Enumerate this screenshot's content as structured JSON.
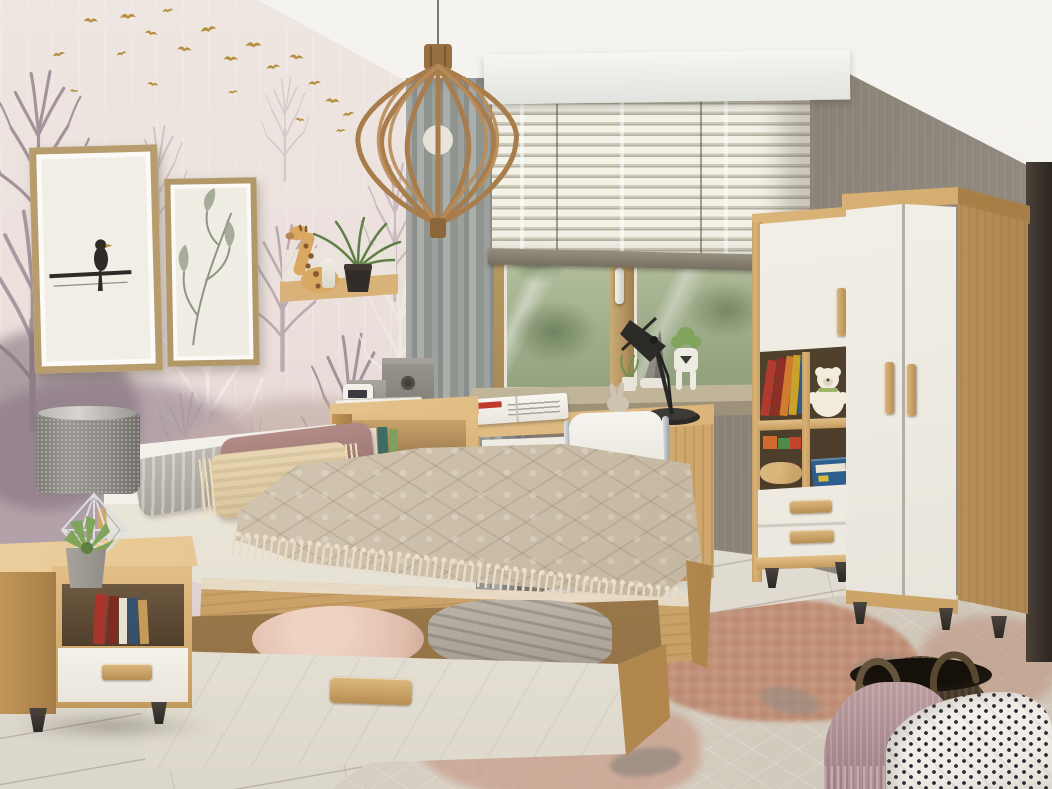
{
  "meta": {
    "type": "interior-photograph",
    "room": "youth bedroom",
    "style": "scandinavian light-oak and white-gloss furniture set",
    "description": "Bright bedroom: forest-mural wallpaper with gold birds on the left wall, two framed prints, wooden cage pendant lamp, gray curtain and venetian-blind window with oak desk and white chair, oak bed with quilted beige spread and an open under-bed drawer, oak nightstand with gray lamp, oak/white bookcase with toys, white-gloss corner wardrobe, patterned rug, wicker basket and a polka-dot bed corner in the foreground."
  },
  "palette": {
    "ceiling": "#f2efe9",
    "back_wall": "#8a8277",
    "wallpaper": "#eae0dc",
    "wallpaper_trees": "#9f8c96",
    "gold_birds": "#b5903f",
    "oak_wood": "#d6b079",
    "white_furniture": "#f2efe7",
    "curtain_gray": "#979b98",
    "blind_slats": "#efeddf",
    "bedspread_beige": "#cfc2ad",
    "pillow_mauve": "#ab8581",
    "floor_planks": "#e2ddd4",
    "rug_rust": "#b97f63",
    "basket_brown": "#42382a",
    "blanket_mauve": "#b39597",
    "polka_fabric": "#f6f3ee"
  },
  "objects": {
    "wallpaper_wall": {
      "label": "Forest mural wallpaper with flock of gold birds"
    },
    "picture_frame_bird": {
      "label": "Framed print of a bird perched on a branch"
    },
    "picture_frame_botanical": {
      "label": "Framed botanical grass print"
    },
    "pendant_lamp": {
      "label": "Wooden cage pendant lamp"
    },
    "curtain": {
      "label": "Gray linen curtain"
    },
    "valance": {
      "label": "White window pelmet"
    },
    "window": {
      "label": "Oak-framed window with venetian blinds and garden view"
    },
    "windowsill": {
      "label": "Windowsill with plants and figurines"
    },
    "desk": {
      "label": "Oak desk with white drawer and open magazine"
    },
    "desk_lamp": {
      "label": "Black articulated task lamp"
    },
    "desk_chair": {
      "label": "White swivel chair with chrome frame"
    },
    "bookcase": {
      "label": "Oak bookcase with white door, books, teddy bear and drawers"
    },
    "wardrobe": {
      "label": "Corner wardrobe with white gloss doors and curved oak side"
    },
    "wall_shelf": {
      "label": "Oak wall shelf with giraffe plush and air plant"
    },
    "headboard_cabinet": {
      "label": "Oak cabinet behind headboard with storage boxes and clock"
    },
    "bed": {
      "label": "Oak single bed with quilted beige tassel bedspread"
    },
    "underbed_drawer": {
      "label": "Open under-bed drawer with pillow and blanket"
    },
    "nightstand": {
      "label": "Oak nightstand with white drawer and books"
    },
    "table_lamp": {
      "label": "Gray table lamp with geometric chrome wire base"
    },
    "succulent": {
      "label": "Succulent in concrete pot"
    },
    "floor": {
      "label": "Whitewashed oak plank floor"
    },
    "rug": {
      "label": "Beige rug with terracotta geometric pattern"
    },
    "basket": {
      "label": "Dark wicker basket"
    },
    "mauve_blanket": {
      "label": "Mauve fringed knit throw"
    },
    "polka_bed": {
      "label": "Bed corner with black polka-dot quilt"
    }
  }
}
